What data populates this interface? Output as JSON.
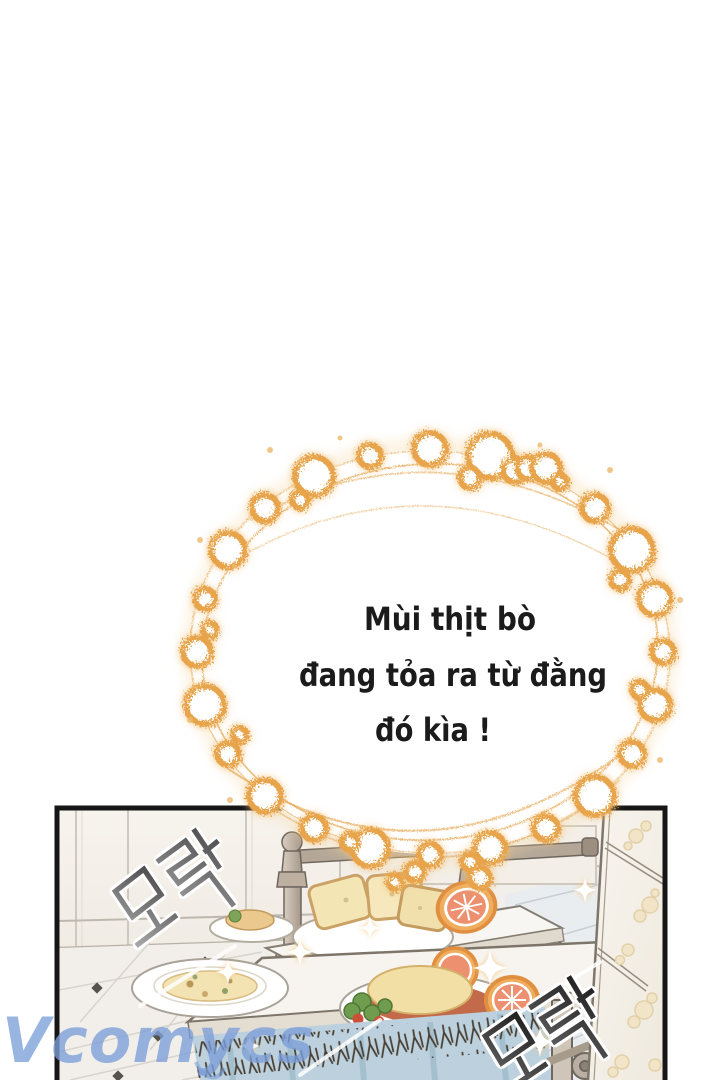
{
  "speech_bubble": {
    "lines": [
      "Mùi thịt bò",
      "đang tỏa ra từ đằng",
      "đó kìa !"
    ],
    "text_color": "#1B1B1B",
    "sparkle_color": "#E8A64E"
  },
  "panel": {
    "sfx_top_left": "모락",
    "sfx_bottom_right": "모락",
    "sfx_color_top_left": "#8A8A8A",
    "sfx_color_bottom_right": "#2B2B2B",
    "skirt_color": "#BCD1DD"
  },
  "watermark": {
    "text": "Vcomycs",
    "color": "#7C9FD9"
  }
}
